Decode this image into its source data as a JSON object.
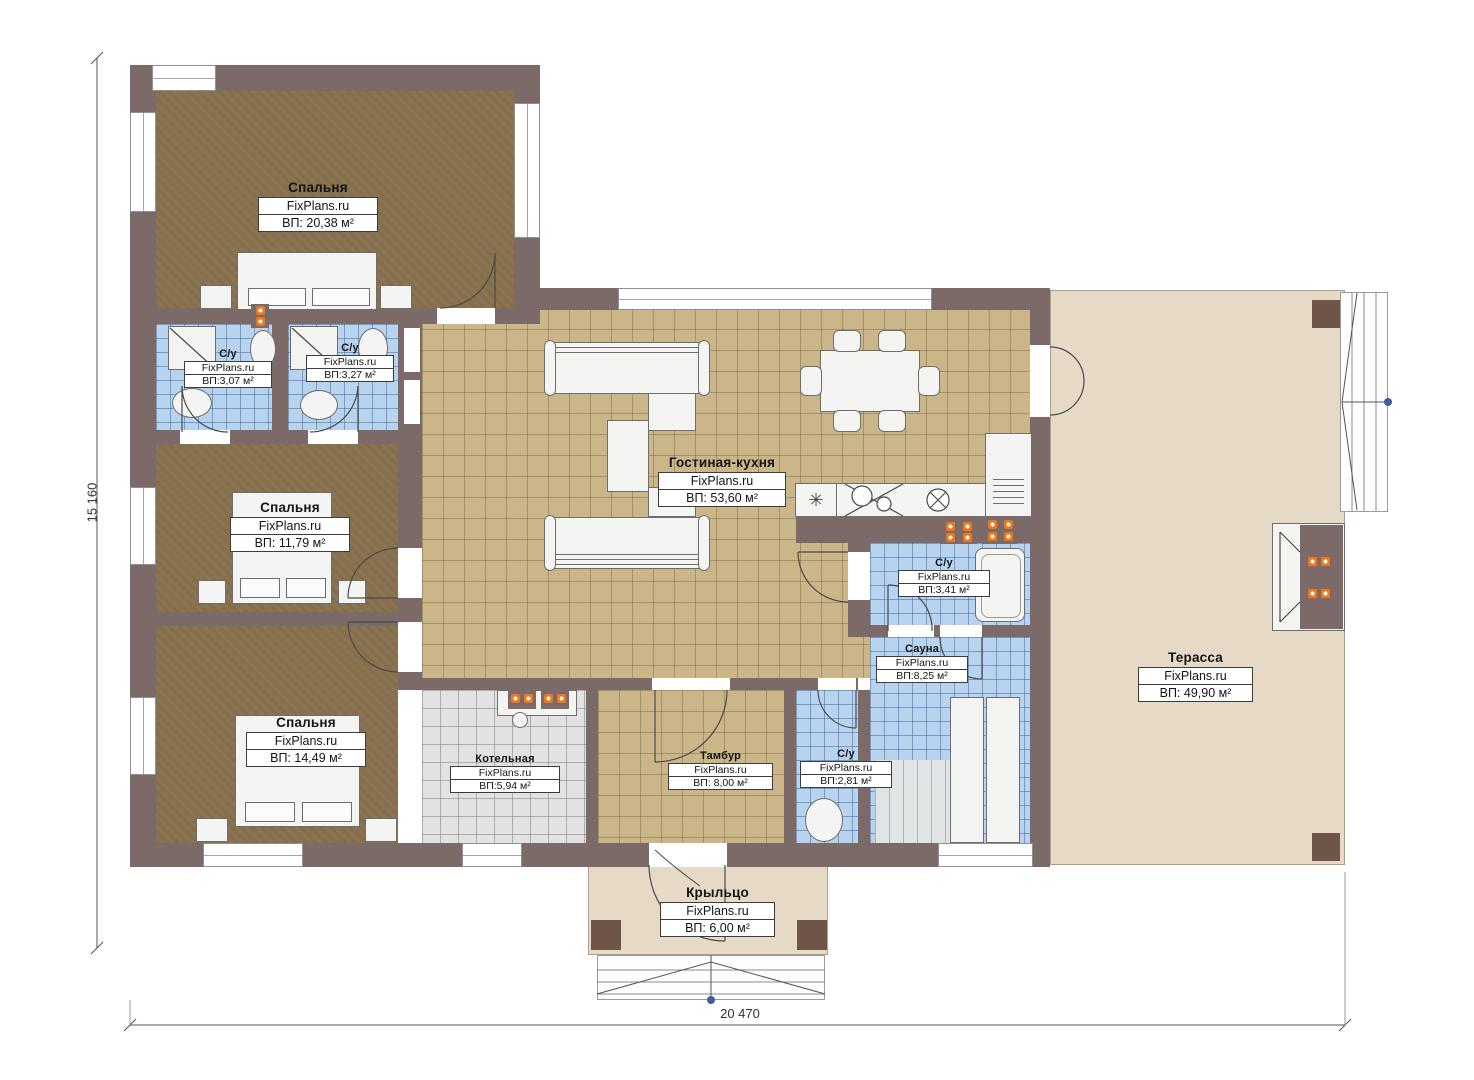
{
  "brand": "FixPlans.ru",
  "dimensions": {
    "height": "15 160",
    "width": "20 470"
  },
  "rooms": {
    "bedroom_1": {
      "name": "Спальня",
      "area": "ВП: 20,38 м²"
    },
    "bath_1": {
      "name": "С/у",
      "area": "ВП:3,07 м²"
    },
    "bath_2": {
      "name": "С/у",
      "area": "ВП:3,27 м²"
    },
    "bedroom_2": {
      "name": "Спальня",
      "area": "ВП: 11,79 м²"
    },
    "bedroom_3": {
      "name": "Спальня",
      "area": "ВП: 14,49 м²"
    },
    "living_kitchen": {
      "name": "Гостиная-кухня",
      "area": "ВП: 53,60 м²"
    },
    "bath_3": {
      "name": "С/у",
      "area": "ВП:3,41 м²"
    },
    "sauna": {
      "name": "Сауна",
      "area": "ВП:8,25 м²"
    },
    "bath_4": {
      "name": "С/у",
      "area": "ВП:2,81 м²"
    },
    "boiler": {
      "name": "Котельная",
      "area": "ВП:5,94 м²"
    },
    "vestibule": {
      "name": "Тамбур",
      "area": "ВП: 8,00 м²"
    },
    "terrace": {
      "name": "Терасса",
      "area": "ВП: 49,90 м²"
    },
    "porch": {
      "name": "Крыльцо",
      "area": "ВП: 6,00 м²"
    }
  },
  "icons": {
    "vent_symbol": "✳"
  },
  "colors": {
    "wall": "#7b6a68",
    "bedroom_floor": "#8a7350",
    "tile_floor": "#cbb689",
    "bath_tile": "#b7d3ee",
    "boiler_tile": "#e2e2e2",
    "terrace_floor": "#e6dac6",
    "accent_orange": "#f07818",
    "marker_blue": "#3b5fa0"
  }
}
